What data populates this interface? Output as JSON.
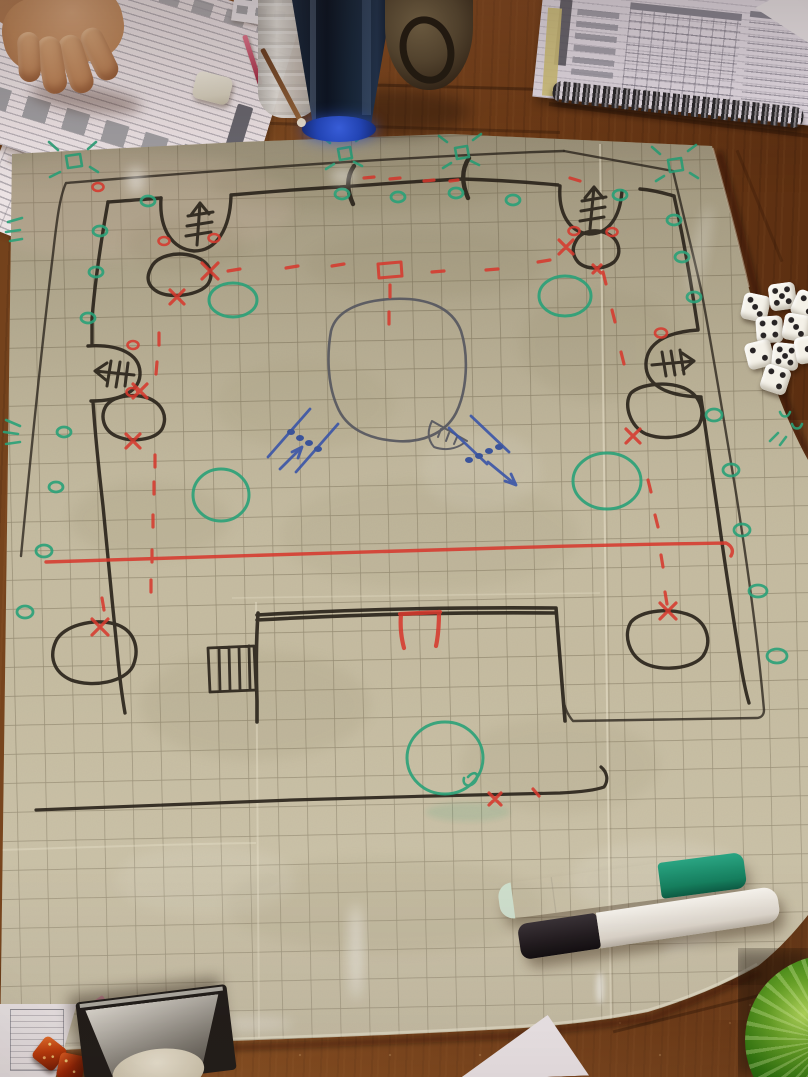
{
  "scene": {
    "description": "Overhead photograph of a tabletop RPG session: a hand-drawn castle battle map on a gridded wet-erase vinyl mat, laid on a wooden table surrounded by character sheets, dice, drinks and dry-erase markers",
    "table": {
      "label": "wooden table",
      "wood_color": "#6e3c18"
    },
    "battle_mat": {
      "label": "vinyl battle mat with square grid",
      "base_color": "#c6bca0",
      "grid_color": "#64593f",
      "map": {
        "label": "hand-drawn castle map",
        "ink_colors": {
          "black_walls": "#2b241c",
          "red_marks": "#d63a2e",
          "green_foliage": "#2aa178",
          "blue_arrows": "#3a55a8",
          "gray_pond": "#54555e"
        },
        "features": [
          "outer castle wall with four towers",
          "hatched ballista arrows drawn in each tower",
          "top gate flanked by two drawn posts",
          "green bush tufts at corners and gate",
          "green lookout circles spaced along the walls",
          "six black boulders each marked with a red X",
          "red dashed patrol routes",
          "solid red line across the courtyard",
          "large gray pond blob in the center",
          "two blue movement arrows with unit dots",
          "inner keep with red gate and portcullis grate",
          "large green circles on the field"
        ]
      }
    },
    "objects": {
      "hand": {
        "label": "player's hand resting on a character sheet"
      },
      "character_sheet": {
        "label": "character record sheet with stat tables"
      },
      "under_sheet": {
        "label": "reference sheet tucked under the mat corner"
      },
      "top_strip_paper": {
        "label": "small paper sheet at the table edge"
      },
      "eraser": {
        "label": "white eraser"
      },
      "pink_pen": {
        "label": "pink pen"
      },
      "pencil": {
        "label": "pencil with pale tip"
      },
      "water_bottle": {
        "label": "translucent plastic water bottle"
      },
      "soda_glass": {
        "label": "dark blue glass of soda with glowing blue base"
      },
      "jug": {
        "label": "brown ceramic jug with handle"
      },
      "notebook": {
        "label": "spiral-bound book opened to rule tables"
      },
      "notebook_spiral": {
        "label": "spiral wire binding"
      },
      "corner_paper": {
        "label": "white paper corner at top right"
      },
      "white_dice": {
        "label": "pile of white six-sided dice",
        "count": 9,
        "pip_color": "#272324"
      },
      "green_marker": {
        "label": "white dry-erase marker with green cap",
        "cap_color": "#1c8f6e"
      },
      "black_marker": {
        "label": "white dry-erase marker with black cap",
        "cap_color": "#221c20"
      },
      "green_glass": {
        "label": "ridged green glass base in bottom-right corner"
      },
      "dice_box": {
        "label": "dark metal dice-box lid with beveled mirror interior"
      },
      "orange_dice": {
        "label": "sparkly orange dice",
        "count": 2
      },
      "bottom_left_paper": {
        "label": "paper sheet edge at bottom left"
      },
      "pink_wrapper": {
        "label": "small pink wrapper"
      },
      "bottom_paper_corner": {
        "label": "white paper corner at bottom center"
      }
    }
  }
}
